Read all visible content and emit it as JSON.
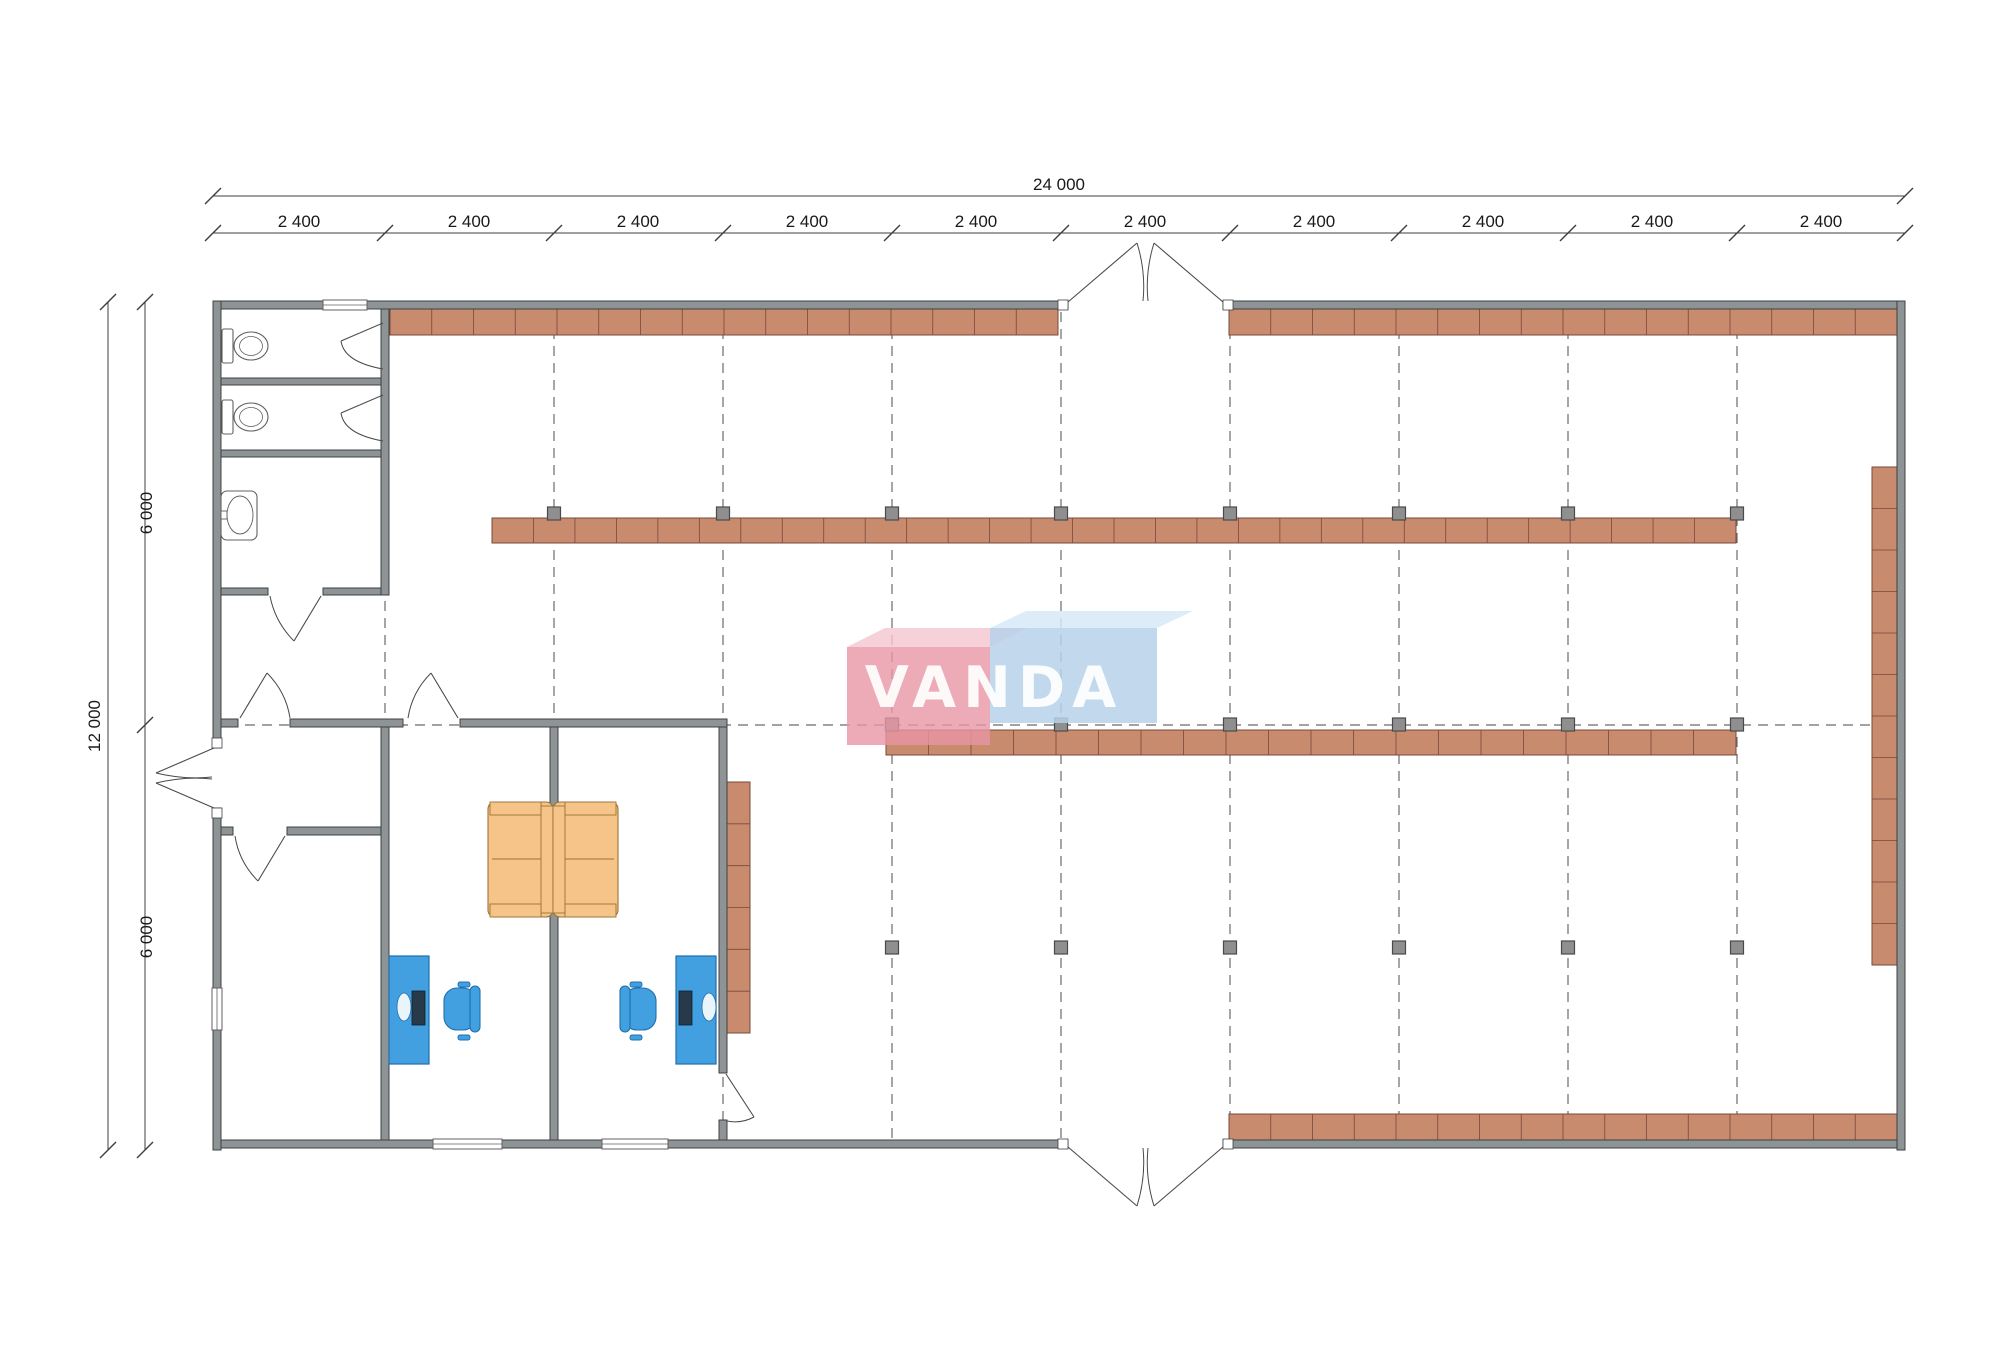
{
  "title": "VANDA retail store floor plan 24000 x 12000",
  "watermark": {
    "text": "VANDA",
    "text_color": "#ffffff",
    "pink_front": "#e895a5",
    "pink_top": "#f4c6cf",
    "blue_front": "#b7d2ea",
    "blue_top": "#d6e9f7",
    "pink_front_poly": [
      847,
      647,
      143,
      98
    ],
    "pink_top_poly": "847,647 885,628 1028,628 990,647",
    "blue_front_poly": [
      990,
      628,
      167,
      95
    ],
    "blue_top_poly": "990,628 1026,611 1193,611 1157,628",
    "text_x": 994,
    "text_y": 707,
    "font_size": 57,
    "letter_spacing": 7
  },
  "colors": {
    "wall_fill": "#8e9396",
    "wall_stroke": "#3e4144",
    "shelf_fill": "#c98b6e",
    "shelf_stroke": "#77493a",
    "column_fill": "#8f8f8f",
    "column_stroke": "#4a4a4a",
    "grid_dash": "#6a6a6a",
    "door_stroke": "#4a4a4a",
    "fixture_stroke": "#606060",
    "dim_stroke": "#3f3f3f",
    "dim_text": "#1a1a1a",
    "desk_fill": "#42a0e0",
    "desk_stroke": "#1f6fae",
    "monitor_fill": "#273a4a",
    "sofa_fill": "#f6c488",
    "sofa_stroke": "#9a7434"
  },
  "dimensions": {
    "font_size": 17,
    "top_total": {
      "label": "24 000",
      "y": 196,
      "x1": 213,
      "x2": 1905,
      "label_x": 1059,
      "label_y": 190
    },
    "top_bays": {
      "y": 233,
      "x1": 213,
      "x2": 1905,
      "label_y": 227,
      "ticks": [
        213,
        385,
        554,
        723,
        892,
        1061,
        1230,
        1399,
        1568,
        1737,
        1905
      ],
      "labels": [
        {
          "t": "2 400",
          "x": 299
        },
        {
          "t": "2 400",
          "x": 469
        },
        {
          "t": "2 400",
          "x": 638
        },
        {
          "t": "2 400",
          "x": 807
        },
        {
          "t": "2 400",
          "x": 976
        },
        {
          "t": "2 400",
          "x": 1145
        },
        {
          "t": "2 400",
          "x": 1314
        },
        {
          "t": "2 400",
          "x": 1483
        },
        {
          "t": "2 400",
          "x": 1652
        },
        {
          "t": "2 400",
          "x": 1821
        }
      ]
    },
    "left_total": {
      "label": "12 000",
      "x": 108,
      "y1": 302,
      "y2": 1150,
      "label_x": 100,
      "label_y": 726
    },
    "left_bays": {
      "x": 145,
      "y1": 302,
      "y2": 1150,
      "label_x": 152,
      "ticks": [
        302,
        725,
        1150
      ],
      "labels": [
        {
          "t": "6 000",
          "y": 513
        },
        {
          "t": "6 000",
          "y": 937
        }
      ]
    }
  },
  "plan": {
    "grid": {
      "vxs": [
        385,
        554,
        723,
        892,
        1061,
        1230,
        1399,
        1568,
        1737
      ],
      "vy1": 312,
      "vy2": 1138,
      "hy": 725,
      "hx1": 228,
      "hx2": 1895,
      "dash": "10 7"
    },
    "walls": [
      {
        "name": "top-wall-west",
        "r": [
          213,
          301,
          855,
          8
        ]
      },
      {
        "name": "top-wall-east",
        "r": [
          1223,
          301,
          682,
          8
        ]
      },
      {
        "name": "bottom-wall-west",
        "r": [
          213,
          1140,
          855,
          8
        ]
      },
      {
        "name": "bottom-wall-east",
        "r": [
          1223,
          1140,
          682,
          8
        ]
      },
      {
        "name": "left-wall-upper",
        "r": [
          213,
          301,
          8,
          447
        ]
      },
      {
        "name": "left-wall-lower",
        "r": [
          213,
          808,
          8,
          342
        ]
      },
      {
        "name": "right-wall",
        "r": [
          1897,
          301,
          8,
          849
        ]
      },
      {
        "name": "toilet-east-wall",
        "r": [
          381,
          309,
          8,
          286
        ]
      },
      {
        "name": "stall-partition-1",
        "r": [
          221,
          378,
          160,
          7
        ]
      },
      {
        "name": "washroom-top-wall",
        "r": [
          221,
          450,
          160,
          7
        ]
      },
      {
        "name": "toilet-south-wall-a",
        "r": [
          221,
          588,
          47,
          7
        ]
      },
      {
        "name": "toilet-south-wall-b",
        "r": [
          323,
          588,
          58,
          7
        ]
      },
      {
        "name": "office-top-wall-a",
        "r": [
          221,
          719,
          17,
          8
        ]
      },
      {
        "name": "office-top-wall-b",
        "r": [
          290,
          719,
          113,
          8
        ]
      },
      {
        "name": "office-top-wall-c",
        "r": [
          460,
          719,
          267,
          8
        ]
      },
      {
        "name": "vestibule-south-wall-a",
        "r": [
          221,
          827,
          12,
          8
        ]
      },
      {
        "name": "vestibule-south-wall-b",
        "r": [
          287,
          827,
          94,
          8
        ]
      },
      {
        "name": "office-west-wall",
        "r": [
          381,
          727,
          8,
          413
        ]
      },
      {
        "name": "office-partition",
        "r": [
          550,
          727,
          8,
          413
        ]
      },
      {
        "name": "office-east-wall",
        "r": [
          719,
          727,
          8,
          346
        ]
      },
      {
        "name": "office-east-wall-stub",
        "r": [
          719,
          1120,
          8,
          20
        ]
      }
    ],
    "jambs": [
      [
        1058,
        300,
        10,
        10
      ],
      [
        1223,
        300,
        10,
        10
      ],
      [
        1058,
        1139,
        10,
        10
      ],
      [
        1223,
        1139,
        10,
        10
      ],
      [
        212,
        738,
        10,
        10
      ],
      [
        212,
        808,
        10,
        10
      ]
    ],
    "windows": [
      {
        "name": "toilet-window",
        "r": [
          323,
          300,
          44,
          10
        ],
        "vertical": false
      },
      {
        "name": "office-a-window",
        "r": [
          433,
          1139,
          69,
          10
        ],
        "vertical": false
      },
      {
        "name": "office-b-window",
        "r": [
          602,
          1139,
          66,
          10
        ],
        "vertical": false
      },
      {
        "name": "storage-window",
        "r": [
          212,
          988,
          10,
          42
        ],
        "vertical": true
      }
    ],
    "shelves": [
      {
        "name": "shelf-top-west",
        "r": [
          390,
          309,
          668,
          26
        ],
        "segments": 16,
        "vertical": false
      },
      {
        "name": "shelf-top-east",
        "r": [
          1229,
          309,
          668,
          26
        ],
        "segments": 16,
        "vertical": false
      },
      {
        "name": "shelf-middle-upper",
        "r": [
          492,
          518,
          1244,
          25
        ],
        "segments": 30,
        "vertical": false
      },
      {
        "name": "shelf-middle-lower",
        "r": [
          886,
          730,
          850,
          25
        ],
        "segments": 20,
        "vertical": false
      },
      {
        "name": "shelf-bottom",
        "r": [
          1229,
          1114,
          668,
          26
        ],
        "segments": 16,
        "vertical": false
      },
      {
        "name": "shelf-right-wall",
        "r": [
          1872,
          467,
          25,
          498
        ],
        "segments": 12,
        "vertical": true
      },
      {
        "name": "office-cabinet",
        "r": [
          727,
          782,
          23,
          251
        ],
        "segments": 6,
        "vertical": true
      }
    ],
    "columns": {
      "size": 13,
      "rows": [
        {
          "name": "column-row-upper",
          "y": 507,
          "xs": [
            554,
            723,
            892,
            1061,
            1230,
            1399,
            1568,
            1737
          ]
        },
        {
          "name": "column-row-center",
          "y": 718,
          "xs": [
            892,
            1061,
            1230,
            1399,
            1568,
            1737
          ]
        },
        {
          "name": "column-row-lower",
          "y": 941,
          "xs": [
            892,
            1061,
            1230,
            1399,
            1568,
            1737
          ]
        }
      ]
    },
    "doors": [
      {
        "name": "entrance-top-door-left",
        "leaf": "M1068,302 L1137,243",
        "arc": "M1137,243 Q1146,272 1143,301"
      },
      {
        "name": "entrance-top-door-right",
        "leaf": "M1223,302 L1154,243",
        "arc": "M1154,243 Q1145,272 1148,301"
      },
      {
        "name": "entrance-bottom-door-left",
        "leaf": "M1068,1147 L1137,1206",
        "arc": "M1137,1206 Q1146,1177 1143,1148"
      },
      {
        "name": "entrance-bottom-door-right",
        "leaf": "M1223,1147 L1154,1206",
        "arc": "M1154,1206 Q1145,1177 1148,1148"
      },
      {
        "name": "entrance-left-door-upper",
        "leaf": "M214,748 L156,773",
        "arc": "M156,773 Q185,780 212,777"
      },
      {
        "name": "entrance-left-door-lower",
        "leaf": "M214,808 L156,783",
        "arc": "M156,783 Q185,776 212,779"
      },
      {
        "name": "vestibule-north-door",
        "leaf": "M240,718 L267,673",
        "arc": "M267,673 Q286,692 290,718"
      },
      {
        "name": "office-a-door",
        "leaf": "M458,718 L431,673",
        "arc": "M431,673 Q412,692 408,718"
      },
      {
        "name": "vestibule-south-door",
        "leaf": "M285,836 L258,881",
        "arc": "M258,881 Q239,862 235,836"
      },
      {
        "name": "washroom-door",
        "leaf": "M321,596 L294,641",
        "arc": "M294,641 Q275,622 270,596"
      },
      {
        "name": "stall-1-door",
        "leaf": "M383,323 L341,341",
        "arc": "M341,341 Q344,362 383,369"
      },
      {
        "name": "stall-2-door",
        "leaf": "M383,395 L341,413",
        "arc": "M341,413 Q344,434 383,441"
      },
      {
        "name": "office-b-door",
        "leaf": "M726,1074 L754,1117",
        "arc": "M754,1117 Q741,1124 727,1121"
      }
    ],
    "toilets": [
      {
        "cy": 346
      },
      {
        "cy": 417
      }
    ],
    "sink": {
      "box": [
        221,
        491,
        36,
        49
      ],
      "oval": [
        240,
        515,
        13,
        19
      ],
      "tap": [
        221,
        511,
        6,
        8
      ]
    },
    "desks": [
      {
        "name": "desk-a",
        "r": [
          389,
          956,
          40,
          108
        ],
        "monitor": [
          412,
          991,
          13,
          34
        ],
        "oval": [
          404,
          1007,
          7,
          14
        ]
      },
      {
        "name": "desk-b",
        "r": [
          676,
          956,
          40,
          108
        ],
        "monitor": [
          679,
          991,
          13,
          34
        ],
        "oval": [
          709,
          1007,
          7,
          14
        ]
      }
    ],
    "chairs": [
      {
        "name": "chair-a",
        "seat": [
          444,
          988,
          32,
          42
        ],
        "back": [
          470,
          986,
          10,
          46
        ],
        "arms": [
          [
            458,
            982,
            12,
            5
          ],
          [
            458,
            1035,
            12,
            5
          ]
        ]
      },
      {
        "name": "chair-b",
        "seat": [
          624,
          988,
          32,
          42
        ],
        "back": [
          620,
          986,
          10,
          46
        ],
        "arms": [
          [
            630,
            982,
            12,
            5
          ],
          [
            630,
            1035,
            12,
            5
          ]
        ]
      }
    ],
    "sofas": [
      {
        "name": "sofa-left",
        "body": [
          488,
          802,
          65,
          115
        ],
        "back": [
          541,
          806,
          12,
          107
        ],
        "arms": [
          [
            490,
            802,
            51,
            13
          ],
          [
            490,
            904,
            51,
            13
          ]
        ],
        "cushion": [
          492,
          859,
          541,
          859
        ]
      },
      {
        "name": "sofa-right",
        "body": [
          553,
          802,
          65,
          115
        ],
        "back": [
          553,
          806,
          12,
          107
        ],
        "arms": [
          [
            565,
            802,
            51,
            13
          ],
          [
            565,
            904,
            51,
            13
          ]
        ],
        "cushion": [
          565,
          859,
          614,
          859
        ]
      }
    ]
  }
}
